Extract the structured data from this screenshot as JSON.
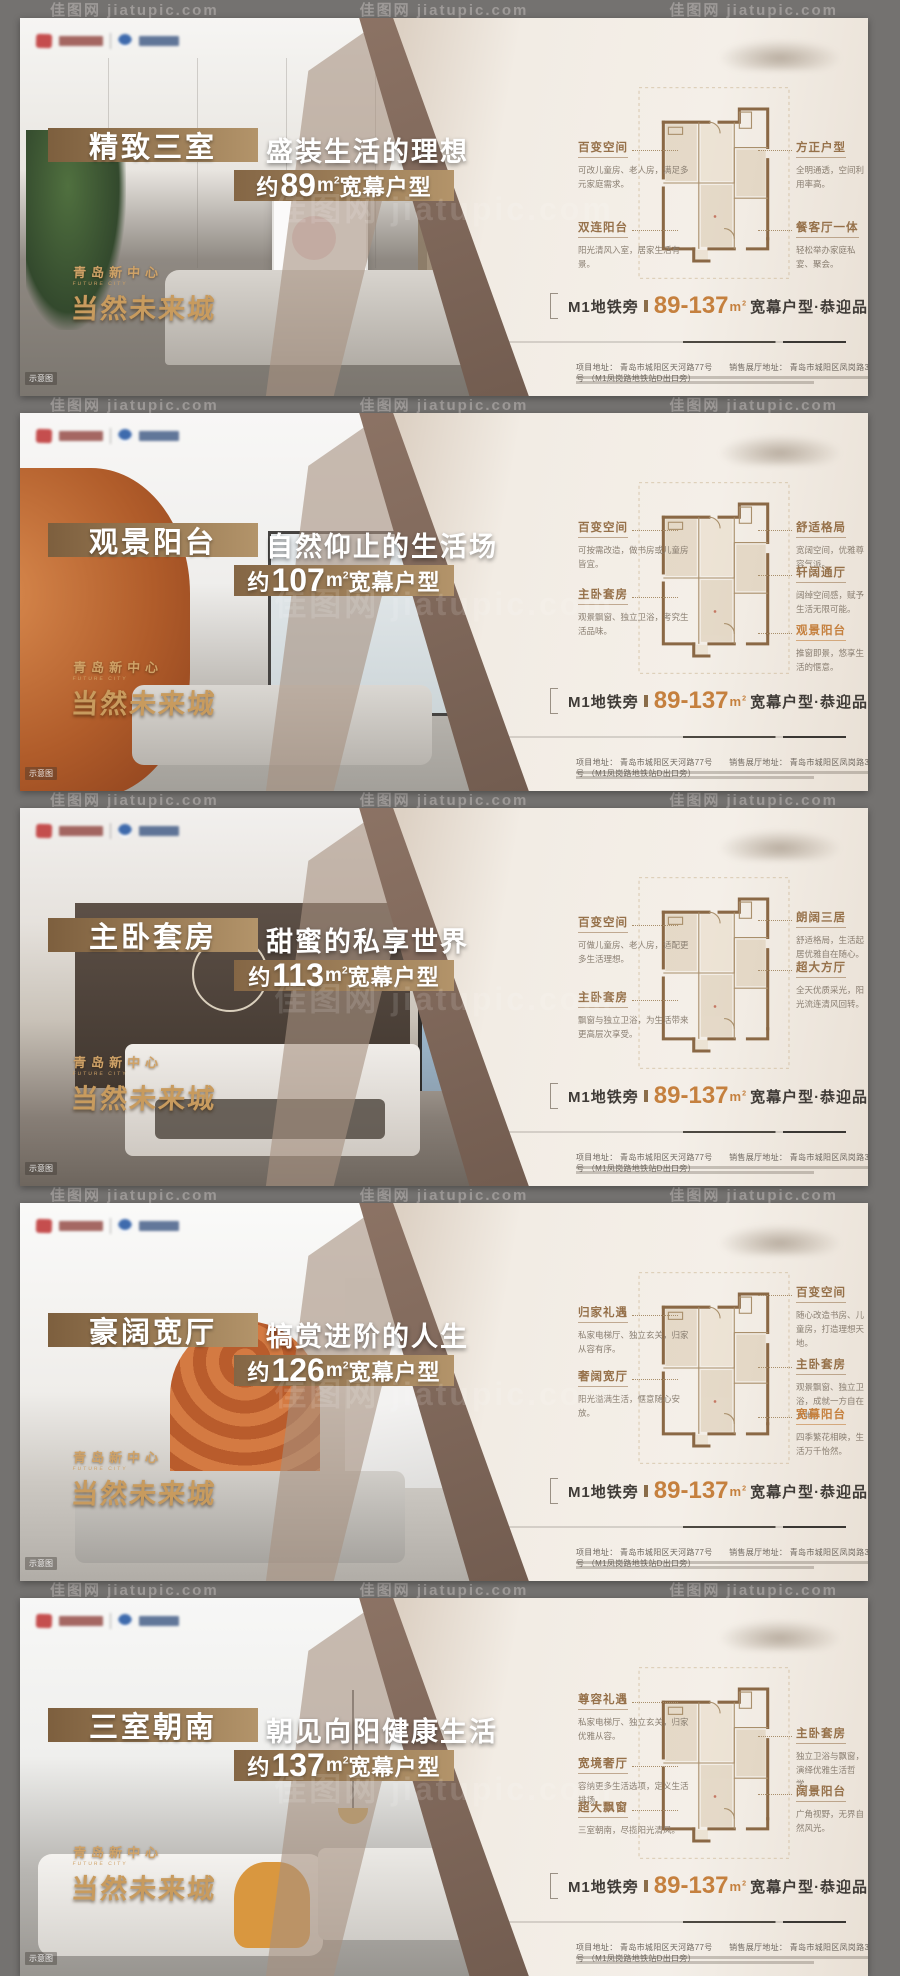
{
  "watermark_text": "佳图网 jiatupic.com",
  "logos": {
    "left_primary": "red-emblem-logo",
    "left_secondary": "blue-globe-logo",
    "sheet_brand": "project-wordmark-blurred"
  },
  "photo_overlay": {
    "location_small": "青岛新中心",
    "location_en": "FUTURE CITY",
    "location_big": "当然未来城",
    "photo_tag": "示意图"
  },
  "area_format": {
    "about": "约",
    "unit": "m",
    "sup": "2",
    "suffix": "宽幕户型"
  },
  "tagline": {
    "prefix": "M1地铁旁",
    "range": "89-137",
    "unit": "m",
    "sup": "2",
    "suffix": "宽幕户型·恭迎品鉴"
  },
  "fine_print": {
    "address": "项目地址： 青岛市城阳区天河路77号　　销售展厅地址： 青岛市城阳区凤岗路31号 （M1凤岗路地铁站D出口旁）"
  },
  "colors": {
    "gold_bar_start": "#7d5f3e",
    "gold_bar_end": "#b3946a",
    "accent_orange": "#c5803e",
    "callout_brown": "#96714a",
    "sheet_bg": "#f2ece4",
    "frame_gray": "#747270"
  },
  "panels": [
    {
      "title": "精致三室",
      "subtitle": "盛装生活的理想",
      "area": "89",
      "callouts": [
        {
          "title": "百变空间",
          "desc": "可改儿童房、老人房，满足多元家庭需求。",
          "side": "left",
          "top": 120
        },
        {
          "title": "双连阳台",
          "desc": "阳光清风入室，居家生活有景。",
          "side": "left",
          "top": 200
        },
        {
          "title": "方正户型",
          "desc": "全明通透，空间利用率高。",
          "side": "right",
          "top": 120
        },
        {
          "title": "餐客厅一体",
          "desc": "轻松举办家庭私宴、聚会。",
          "side": "right",
          "top": 200
        }
      ]
    },
    {
      "title": "观景阳台",
      "subtitle": "自然仰止的生活场",
      "area": "107",
      "callouts": [
        {
          "title": "百变空间",
          "desc": "可按需改造，做书房或儿童房皆宜。",
          "side": "left",
          "top": 105
        },
        {
          "title": "主卧套房",
          "desc": "观景飘窗、独立卫浴，考究生活品味。",
          "side": "left",
          "top": 172
        },
        {
          "title": "舒适格局",
          "desc": "宽阔空间，优雅尊容气派。",
          "side": "right",
          "top": 105
        },
        {
          "title": "轩阔通厅",
          "desc": "阔绰空间感，赋予生活无限可能。",
          "side": "right",
          "top": 150
        },
        {
          "title": "观景阳台",
          "desc": "推窗即景，悠享生活的惬意。",
          "side": "right",
          "top": 208,
          "accent": true
        }
      ]
    },
    {
      "title": "主卧套房",
      "subtitle": "甜蜜的私享世界",
      "area": "113",
      "callouts": [
        {
          "title": "百变空间",
          "desc": "可做儿童房、老人房，适配更多生活理想。",
          "side": "left",
          "top": 105
        },
        {
          "title": "主卧套房",
          "desc": "飘窗与独立卫浴，为生活带来更高层次享受。",
          "side": "left",
          "top": 180
        },
        {
          "title": "朗阔三居",
          "desc": "舒适格局，生活起居优雅自在随心。",
          "side": "right",
          "top": 100
        },
        {
          "title": "超大方厅",
          "desc": "全天优质采光，阳光流连清风回转。",
          "side": "right",
          "top": 150
        }
      ]
    },
    {
      "title": "豪阔宽厅",
      "subtitle": "犒赏进阶的人生",
      "area": "126",
      "callouts": [
        {
          "title": "归家礼遇",
          "desc": "私家电梯厅、独立玄关，归家从容有序。",
          "side": "left",
          "top": 100
        },
        {
          "title": "奢阔宽厅",
          "desc": "阳光溢满生活，惬意随心安放。",
          "side": "left",
          "top": 164
        },
        {
          "title": "百变空间",
          "desc": "随心改造书房、儿童房，打造理想天地。",
          "side": "right",
          "top": 80
        },
        {
          "title": "主卧套房",
          "desc": "观景飘窗、独立卫浴，成就一方自在天地。",
          "side": "right",
          "top": 152
        },
        {
          "title": "宽幕阳台",
          "desc": "四季繁花相映，生活万千怡然。",
          "side": "right",
          "top": 202,
          "accent": true
        }
      ]
    },
    {
      "title": "三室朝南",
      "subtitle": "朝见向阳健康生活",
      "area": "137",
      "callouts": [
        {
          "title": "尊容礼遇",
          "desc": "私家电梯厅、独立玄关，归家优雅从容。",
          "side": "left",
          "top": 92
        },
        {
          "title": "宽境奢厅",
          "desc": "容纳更多生活选项，定义生活排场。",
          "side": "left",
          "top": 156
        },
        {
          "title": "超大飘窗",
          "desc": "三室朝南，尽揽阳光清风。",
          "side": "left",
          "top": 200
        },
        {
          "title": "主卧套房",
          "desc": "独立卫浴与飘窗，演绎优雅生活哲学。",
          "side": "right",
          "top": 126
        },
        {
          "title": "阔景阳台",
          "desc": "广角视野，无界自然风光。",
          "side": "right",
          "top": 184
        }
      ]
    }
  ]
}
